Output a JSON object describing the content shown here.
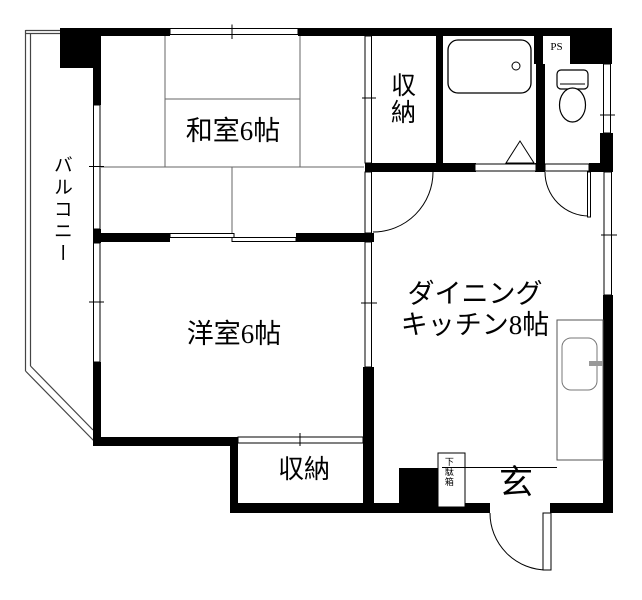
{
  "floorplan": {
    "labels": {
      "japanese_room": "和室6帖",
      "western_room": "洋室6帖",
      "dining_kitchen_line1": "ダイニング",
      "dining_kitchen_line2": "キッチン8帖",
      "storage_top": "収納",
      "storage_bottom": "収納",
      "balcony": "バルコニー",
      "entrance": "玄",
      "pipe_space": "PS",
      "shoe_cabinet": "下駄箱"
    },
    "fixtures": [
      "bathtub-icon",
      "toilet-icon",
      "kitchen-sink-icon",
      "door-swing-arc",
      "folding-door-triangle"
    ],
    "colors": {
      "wall": "#000000",
      "background": "#ffffff",
      "tatami_line": "#666666",
      "faucet": "#999999"
    }
  }
}
